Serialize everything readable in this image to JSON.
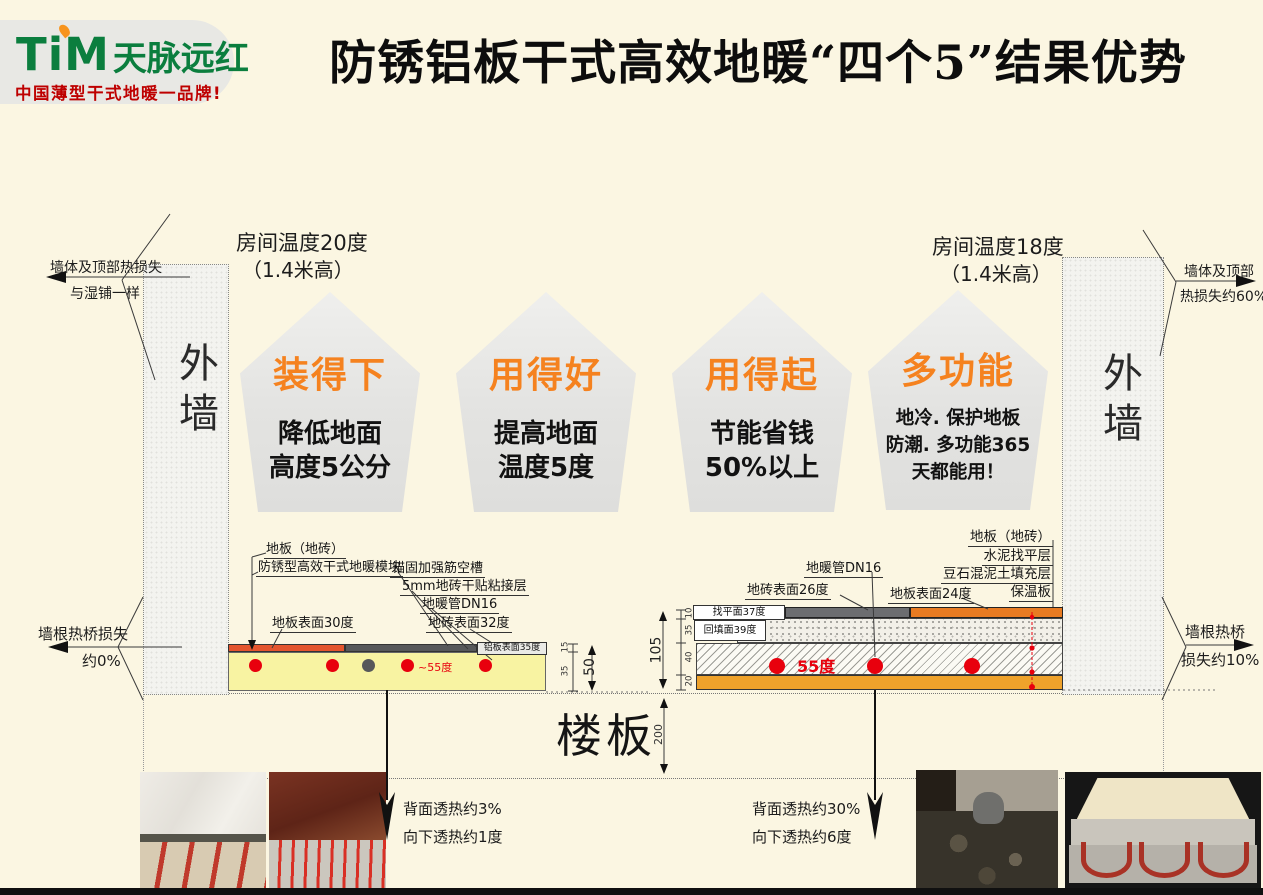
{
  "header": {
    "logo": {
      "brand": "TiM",
      "brand_cn": "天脉远红",
      "tagline": "中国薄型干式地暖一品牌!"
    },
    "title": "防锈铝板干式高效地暖“四个5”结果优势"
  },
  "room_left": {
    "line1": "房间温度20度",
    "line2": "（1.4米高）"
  },
  "room_right": {
    "line1": "房间温度18度",
    "line2": "（1.4米高）"
  },
  "walls": {
    "left": "外墙",
    "right": "外墙"
  },
  "callouts": {
    "top_left": {
      "line1": "墙体及顶部热损失",
      "line2": "与湿铺一样"
    },
    "top_right": {
      "line1": "墙体及顶部",
      "line2": "热损失约60%"
    },
    "mid_left": {
      "line1": "墙根热桥损失",
      "line2": "约0%"
    },
    "mid_right": {
      "line1": "墙根热桥",
      "line2": "损失约10%"
    }
  },
  "pentagons": [
    {
      "title": "装得下",
      "lines": [
        "降低地面",
        "高度5公分"
      ]
    },
    {
      "title": "用得好",
      "lines": [
        "提高地面",
        "温度5度"
      ]
    },
    {
      "title": "用得起",
      "lines": [
        "节能省钱",
        "50%以上"
      ]
    },
    {
      "title": "多功能",
      "lines": [
        "地冷. 保护地板",
        "防潮. 多功能365",
        "天都能用！"
      ]
    }
  ],
  "dry_section": {
    "labels": {
      "floor": "地板（地砖）",
      "module": "防锈型高效干式地暖模块",
      "groove": "锚固加强筋空槽",
      "adhesive": "5mm地砖干贴粘接层",
      "pipe": "地暖管DN16",
      "floor_surface": "地板表面30度",
      "tile_surface": "地砖表面32度",
      "alu_surface": "铝板表面35度",
      "water_temp": "~55度"
    },
    "dims": {
      "d1": "15",
      "d2": "35",
      "total": "50"
    }
  },
  "wet_section": {
    "labels": {
      "floor": "地板（地砖）",
      "leveling": "水泥找平层",
      "fill": "豆石混泥土填充层",
      "insulation": "保温板",
      "pipe": "地暖管DN16",
      "tile_surface": "地砖表面26度",
      "floor_surface": "地板表面24度",
      "level_surface": "找平面37度",
      "fill_surface": "回填面39度",
      "water_temp": "55度"
    },
    "dims": {
      "d1": "10",
      "d2": "35",
      "d3": "40",
      "d4": "20",
      "total": "105"
    }
  },
  "slab": {
    "label": "楼板",
    "dim": "200"
  },
  "notes": {
    "left": {
      "line1": "背面透热约3%",
      "line2": "向下透热约1度"
    },
    "right": {
      "line1": "背面透热约30%",
      "line2": "向下透热约6度"
    }
  },
  "colors": {
    "background": "#FBF6E2",
    "accent_orange": "#F5821F",
    "logo_green": "#0B7E3E",
    "tagline_red": "#BE0000",
    "pipe_red": "#E8000D",
    "dry_alu_red": "#E4552E",
    "dark_gray": "#57585A",
    "dry_yellow": "#F8F3A2",
    "wet_orange": "#E87B22",
    "insulation_orange": "#EFA22B"
  }
}
